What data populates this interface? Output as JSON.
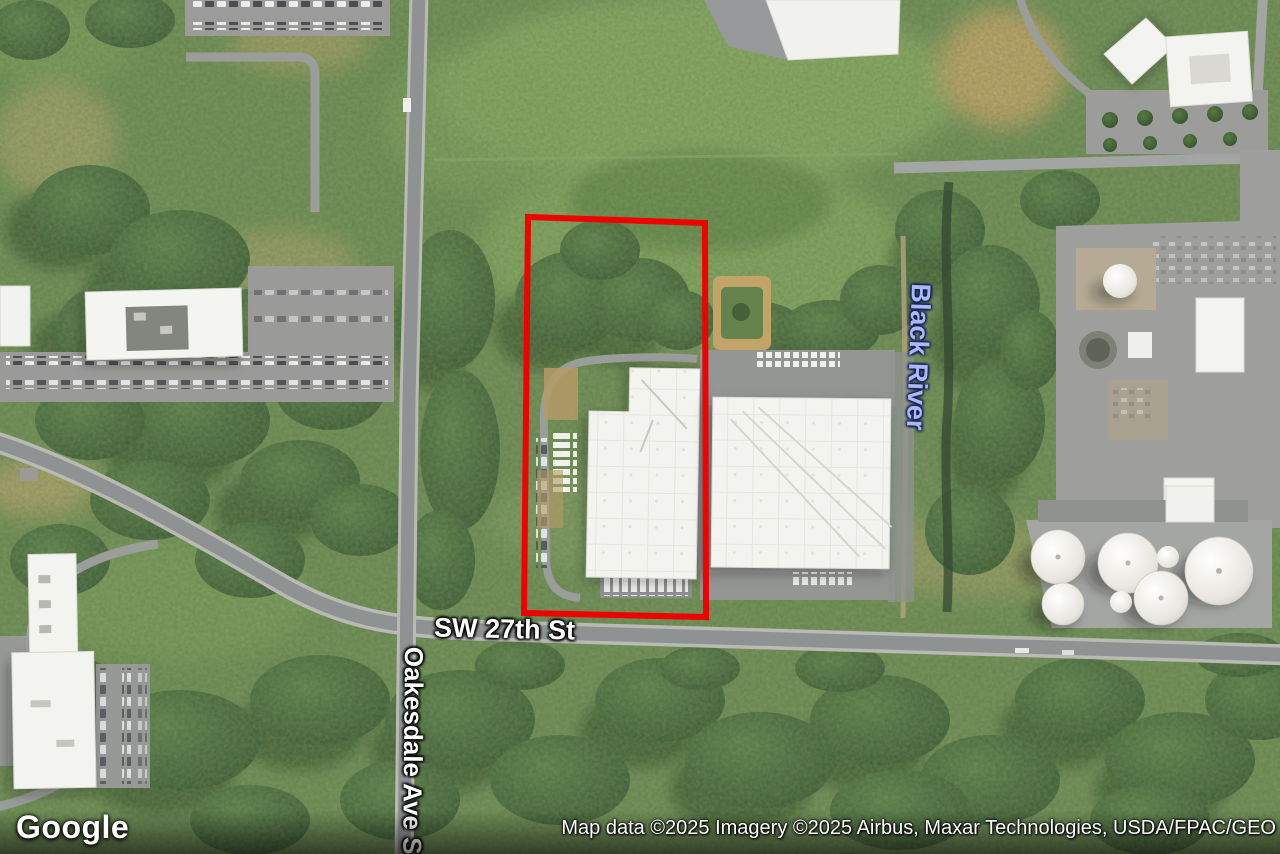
{
  "map": {
    "view_type": "satellite",
    "street_labels": [
      {
        "text": "SW 27th St"
      },
      {
        "text": "Oakesdale Ave S"
      }
    ],
    "water_label": {
      "text": "Black River",
      "color": "#a9b8f7"
    },
    "parcel_outline": {
      "color": "#ee0202",
      "shape": "rectangle"
    }
  },
  "branding": {
    "logo_text": "Google"
  },
  "attribution": {
    "text": "Map data ©2025 Imagery ©2025 Airbus, Maxar Technologies, USDA/FPAC/GEO"
  }
}
